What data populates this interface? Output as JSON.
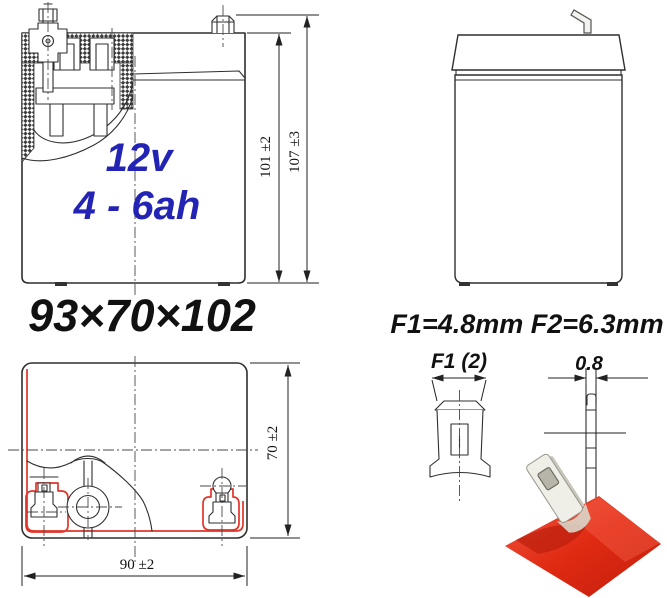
{
  "diagram": {
    "front_view": {
      "voltage": "12v",
      "capacity": "4 - 6ah",
      "dim_case_height": "101 ±2",
      "dim_total_height": "107 ±3"
    },
    "overall_size": "93×70×102",
    "top_view": {
      "dim_depth": "70 ±2",
      "dim_width": "90 ±2"
    },
    "terminal": {
      "title": "F1=4.8mm F2=6.3mm",
      "front_width_label": "F1 (2)",
      "thickness_label": "0.8"
    },
    "colors": {
      "accent_blue": "#2424b4",
      "outline_red": "#e0352b",
      "photo_red": "#d92814",
      "line_dark": "#2f2f2f"
    }
  }
}
